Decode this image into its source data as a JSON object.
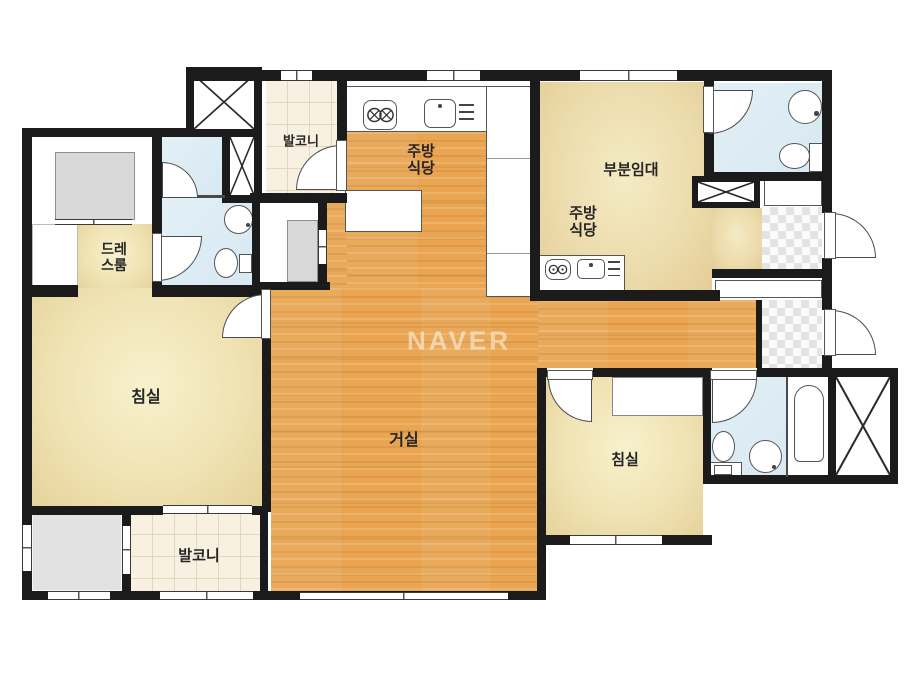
{
  "watermark": "NAVER",
  "rooms": {
    "balcony_top": "발코니",
    "kitchen_dining": [
      "주방",
      "식당"
    ],
    "partial_rental": "부분임대",
    "rental_kitchen_dining": [
      "주방",
      "식당"
    ],
    "dress_room": [
      "드레",
      "스룸"
    ],
    "bedroom_left": "침실",
    "living_room": "거실",
    "bedroom_right": "침실",
    "balcony_bottom": "발코니"
  },
  "colors": {
    "wall": "#1b1b1b",
    "wood_floor": "#e9a551",
    "bedroom_beige": "#f0e3b4",
    "rental_beige": "#ecdbab",
    "balcony_cream": "#f8f0e1",
    "bathroom_blue": "#d8e9f2",
    "utility_gray": "#e2e2e2",
    "background": "#ffffff"
  }
}
